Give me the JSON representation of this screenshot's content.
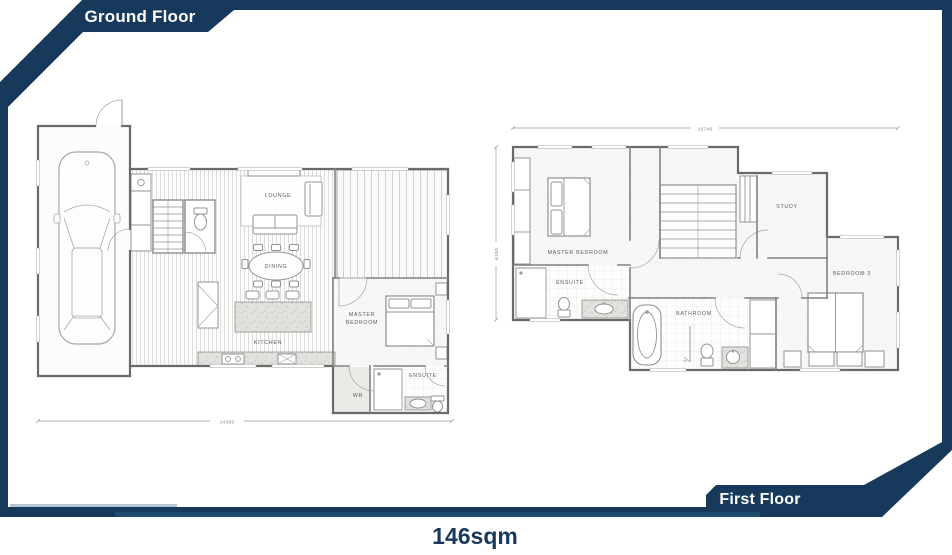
{
  "banners": {
    "ground": "Ground Floor",
    "first": "First Floor"
  },
  "area_label": "146sqm",
  "colors": {
    "navy": "#16395c",
    "accent_light": "#b7c6d4",
    "accent_mid": "#1f4b71",
    "plan_line": "#808080"
  },
  "ground_floor": {
    "labels": {
      "lounge": "LOUNGE",
      "dining": "DINING",
      "kitchen": "KITCHEN",
      "master_line1": "MASTER",
      "master_line2": "BEDROOM",
      "wr": "WR",
      "ensuite": "ENSUITE"
    },
    "dimensions": {
      "width": "14300"
    }
  },
  "first_floor": {
    "labels": {
      "master": "MASTER BEDROOM",
      "ensuite": "ENSUITE",
      "study": "STUDY",
      "bedroom3": "BEDROOM 3",
      "bathroom": "BATHROOM"
    },
    "dimensions": {
      "width": "10740",
      "height": "6150"
    }
  }
}
